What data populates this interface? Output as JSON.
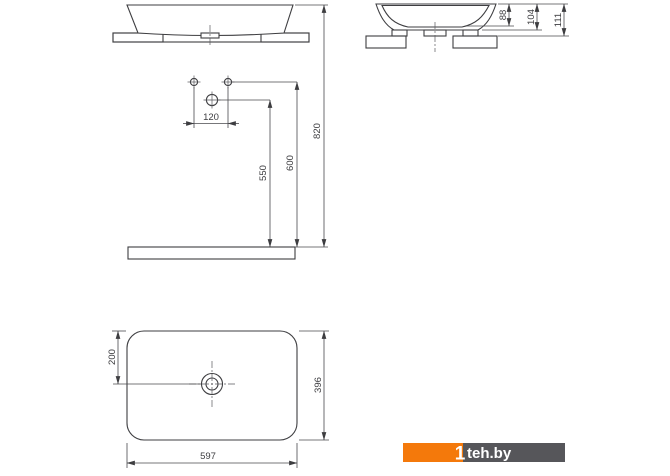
{
  "dims": {
    "d88": "88",
    "d104": "104",
    "d111": "111",
    "d120": "120",
    "d550": "550",
    "d600": "600",
    "d820": "820",
    "d200": "200",
    "d396": "396",
    "d597": "597"
  },
  "watermark": {
    "one": "1",
    "site": "teh.by",
    "orange_color": "#f4790b",
    "gray_color": "#56565a",
    "text_color": "#ffffff"
  },
  "colors": {
    "line": "#3d3d40",
    "background": "#ffffff"
  }
}
